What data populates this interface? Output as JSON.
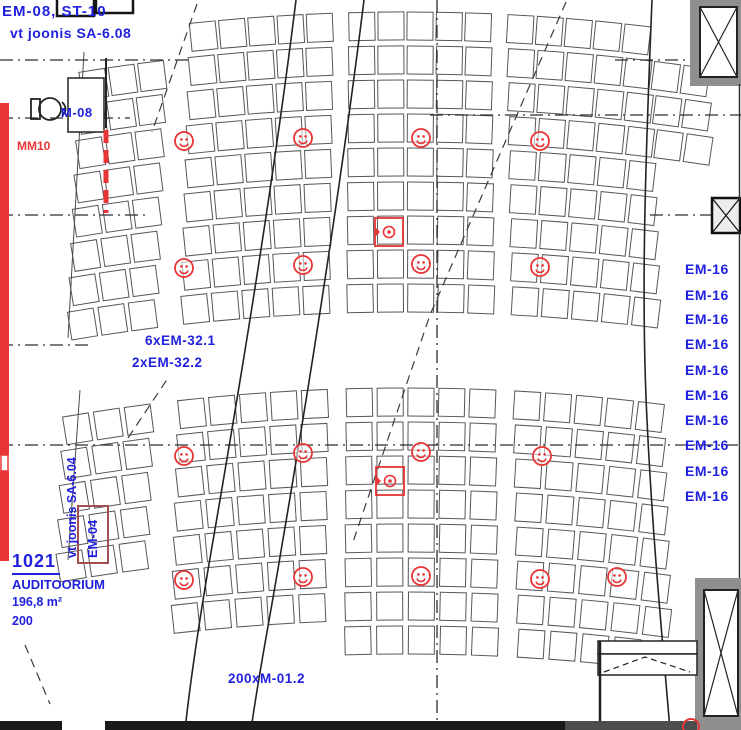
{
  "colors": {
    "red": "#e83434",
    "blue": "#2121dd",
    "dark_red": "#a05050"
  },
  "header": {
    "ref_line1": "EM-08, ST-10",
    "ref_line2": "vt joonis SA-6.08"
  },
  "labels": {
    "m08": "M-08",
    "mm10": "MM10",
    "em321": "6xEM-32.1",
    "em322": "2xEM-32.2",
    "sa604": "vt joonis SA-6.04",
    "em04": "EM-04",
    "m012": "200xM-01.2"
  },
  "room": {
    "number": "1021",
    "name": "AUDITOORIUM",
    "area": "196,8 m²",
    "capacity": "200"
  },
  "em16": [
    "EM-16",
    "EM-16",
    "EM-16",
    "EM-16",
    "EM-16",
    "EM-16",
    "EM-16",
    "EM-16",
    "EM-16",
    "EM-16"
  ],
  "symbols": {
    "speakers": [
      [
        184,
        141
      ],
      [
        303,
        138
      ],
      [
        421,
        138
      ],
      [
        540,
        141
      ],
      [
        184,
        268
      ],
      [
        303,
        265
      ],
      [
        421,
        264
      ],
      [
        540,
        267
      ],
      [
        184,
        456
      ],
      [
        303,
        453
      ],
      [
        421,
        452
      ],
      [
        542,
        456
      ],
      [
        184,
        580
      ],
      [
        303,
        577
      ],
      [
        421,
        576
      ],
      [
        540,
        579
      ],
      [
        617,
        577
      ]
    ],
    "fixtures": [
      [
        389,
        232
      ],
      [
        390,
        481
      ]
    ]
  }
}
